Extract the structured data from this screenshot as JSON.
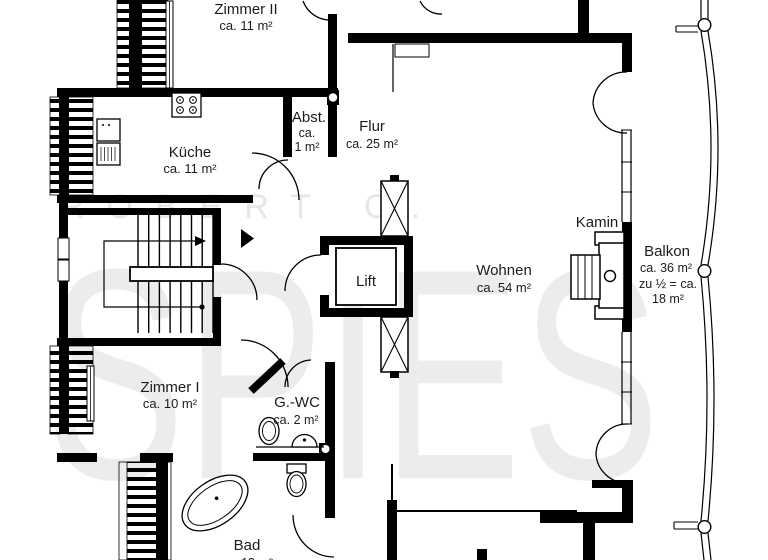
{
  "watermark": {
    "line1": "ROBERT C.",
    "line2": "SPIES"
  },
  "rooms": {
    "zimmer2": {
      "name": "Zimmer II",
      "area": "ca. 11 m²"
    },
    "kueche": {
      "name": "Küche",
      "area": "ca. 11 m²"
    },
    "abst": {
      "name": "Abst.",
      "area_line1": "ca.",
      "area_line2": "1 m²"
    },
    "flur": {
      "name": "Flur",
      "area": "ca. 25 m²"
    },
    "lift": {
      "name": "Lift"
    },
    "wohnen": {
      "name": "Wohnen",
      "area": "ca. 54 m²"
    },
    "kamin": {
      "name": "Kamin"
    },
    "balkon": {
      "name": "Balkon",
      "area_line1": "ca. 36 m²",
      "area_line2": "zu ½ = ca.",
      "area_line3": "18 m²"
    },
    "zimmer1": {
      "name": "Zimmer I",
      "area": "ca. 10 m²"
    },
    "gwc": {
      "name": "G.-WC",
      "area": "ca. 2 m²"
    },
    "bad": {
      "name": "Bad",
      "area": "ca. 13 m²"
    }
  },
  "colors": {
    "wall": "#000000",
    "background": "#ffffff",
    "watermark": "#e9e9e9"
  }
}
